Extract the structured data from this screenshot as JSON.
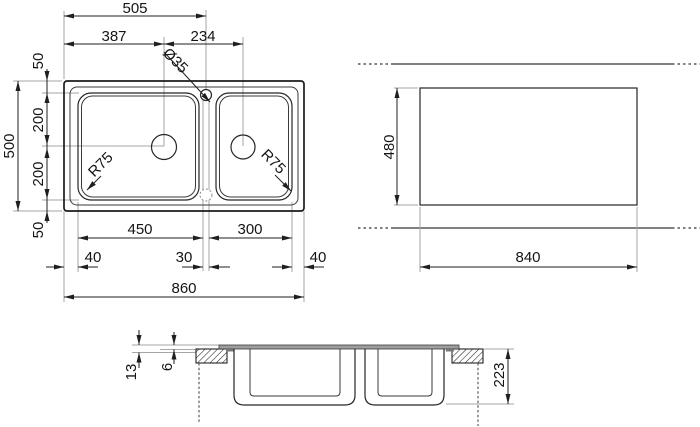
{
  "plan": {
    "d505": "505",
    "d387": "387",
    "d234": "234",
    "hole_dia": "Ø35",
    "d50_top": "50",
    "d200_upper": "200",
    "d200_lower": "200",
    "d50_bottom": "50",
    "d500": "500",
    "r75_left": "R75",
    "r75_right": "R75",
    "d450": "450",
    "d300": "300",
    "d40_left": "40",
    "d30": "30",
    "d40_right": "40",
    "d860": "860"
  },
  "cutout": {
    "d480": "480",
    "d840": "840"
  },
  "section": {
    "d13": "13",
    "d6": "6",
    "d223": "223"
  },
  "colors": {
    "line": "#1f1f1f",
    "extension_line": "#a6a6a6",
    "rim_fill": "#9e9e9e",
    "dash_line": "#575757",
    "background": "#ffffff"
  }
}
